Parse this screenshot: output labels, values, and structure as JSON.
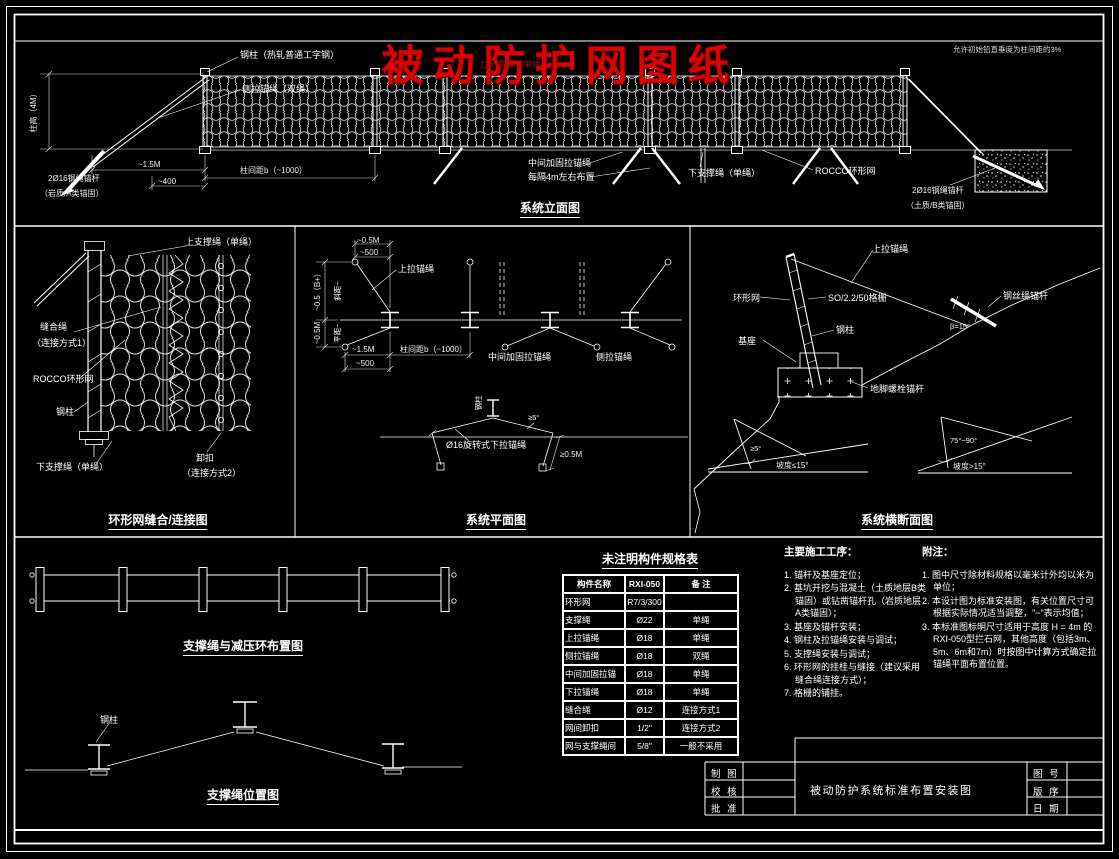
{
  "colors": {
    "background": "#000000",
    "line": "#ffffff",
    "accent_red": "#dd0000"
  },
  "header": {
    "main_title": "被动防护网图纸",
    "overlap_label": "上支撑绳（单绳）",
    "tolerance_note": "允许初始铅直垂度为柱间距的3%"
  },
  "elevation": {
    "title": "系统立面图",
    "post_label": "钢柱（热轧普通工字钢）",
    "side_anchor_label": "侧拉锚绳（双绳）",
    "height_dim": "柱高（4M）",
    "dim_anchor_offset": "~1.5M",
    "dim_anchor_mm": "~400",
    "anchor_left_line1": "2Ø16钢绳锚杆",
    "anchor_left_line2": "（岩质/A类锚固）",
    "span_dim": "柱间距b（~1000）",
    "mid_anchor_line1": "中间加固拉锚绳",
    "mid_anchor_line2": "每隔4m左右布置",
    "lower_rope_label": "下支撑绳（单绳）",
    "net_label": "ROCCO环形网",
    "anchor_right_line1": "2Ø16钢绳锚杆",
    "anchor_right_line2": "（土质/B类锚固）"
  },
  "ring_panel": {
    "title": "环形网缝合/连接图",
    "upper_rope_label": "上支撑绳（单绳）",
    "seam_rope_label": "缝合绳",
    "seam_method_label": "（连接方式1）",
    "net_label": "ROCCO环形网",
    "post_label": "钢柱",
    "lower_rope_label": "下支撑绳（单绳）",
    "shackle_label": "卸扣",
    "shackle_method_label": "（连接方式2）"
  },
  "plan": {
    "title": "系统平面图",
    "dim_top_m": "~0.5M",
    "dim_top_mm": "~500",
    "upper_anchor_label": "上拉锚绳",
    "dim_left_upper": "~0.5（B+）",
    "dim_left_upper_inner": "斜距~",
    "dim_left_lower": "~0.5M",
    "dim_left_lower_inner": "平距~",
    "dim_bottom_m": "~1.5M",
    "dim_bottom_mm": "~500",
    "span_dim": "柱间距b（~1000）",
    "mid_anchor_label": "中间加固拉锚绳",
    "side_anchor_label": "侧拉锚绳",
    "swivel_anchor_label": "Ø16旋转式下拉锚绳",
    "angle_label": "≥5°",
    "offset_dim": "≥0.5M",
    "post_label": "钢柱"
  },
  "section": {
    "title": "系统横断面图",
    "upper_anchor_label": "上拉锚绳",
    "net_label": "环形网",
    "mesh_spec_label": "SO/2.2/50格栅",
    "post_label": "钢柱",
    "base_label": "基座",
    "base_anchor_label": "地脚螺栓锚杆",
    "wire_anchor_label": "钢丝绳锚杆",
    "beta_label": "β=15°",
    "tri_left_angle": "≥5°",
    "tri_left_slope": "坡度≤15°",
    "tri_right_angle": "75°~90°",
    "tri_right_slope": "坡度>15°"
  },
  "support_layout": {
    "title": "支撑绳与减压环布置图"
  },
  "support_position": {
    "title": "支撑绳位置图",
    "post_label": "钢柱"
  },
  "spec_table": {
    "title": "未注明构件规格表",
    "headers": [
      "构件名称",
      "RXI-050",
      "备 注"
    ],
    "rows": [
      [
        "环形网",
        "R7/3/300",
        ""
      ],
      [
        "支撑绳",
        "Ø22",
        "单绳"
      ],
      [
        "上拉锚绳",
        "Ø18",
        "单绳"
      ],
      [
        "侧拉锚绳",
        "Ø18",
        "双绳"
      ],
      [
        "中间加固拉锚绳",
        "Ø18",
        "单绳"
      ],
      [
        "下拉锚绳",
        "Ø18",
        "单绳"
      ],
      [
        "缝合绳",
        "Ø12",
        "连接方式1"
      ],
      [
        "网间卸扣",
        "1/2\"",
        "连接方式2"
      ],
      [
        "网与支撑绳间卸扣",
        "5/8\"",
        "一般不采用"
      ]
    ]
  },
  "construction": {
    "heading": "主要施工工序：",
    "items": [
      "1. 锚杆及基座定位；",
      "2. 基坑开挖与混凝土（土质地层B类锚固）或钻凿锚杆孔（岩质地层A类锚固）；",
      "3. 基座及锚杆安装；",
      "4. 钢柱及拉锚绳安装与调试；",
      "5. 支撑绳安装与调试；",
      "6. 环形网的挂桂与缝接（建议采用缝合绳连接方式）；",
      "7. 格栅的铺挂。"
    ]
  },
  "notes": {
    "heading": "附注：",
    "items": [
      "1. 图中尺寸除材料规格以毫米计外均以米为单位；",
      "2. 本设计图为标准安装图，有关位置尺寸可根据实际情况适当调整，\"~\"表示均值；",
      "3. 本标准图标明尺寸适用于高度 H = 4m 的RXI-050型拦石网，其他高度（包括3m、5m、6m和7m）时按图中计算方式确定拉锚绳平面布置位置。"
    ]
  },
  "title_block": {
    "made_label": "制 图",
    "check_label": "校 核",
    "approve_label": "批 准",
    "drawing_title": "被动防护系统标准布置安装图",
    "no_label": "图 号",
    "rev_label": "版 序",
    "date_label": "日 期"
  }
}
